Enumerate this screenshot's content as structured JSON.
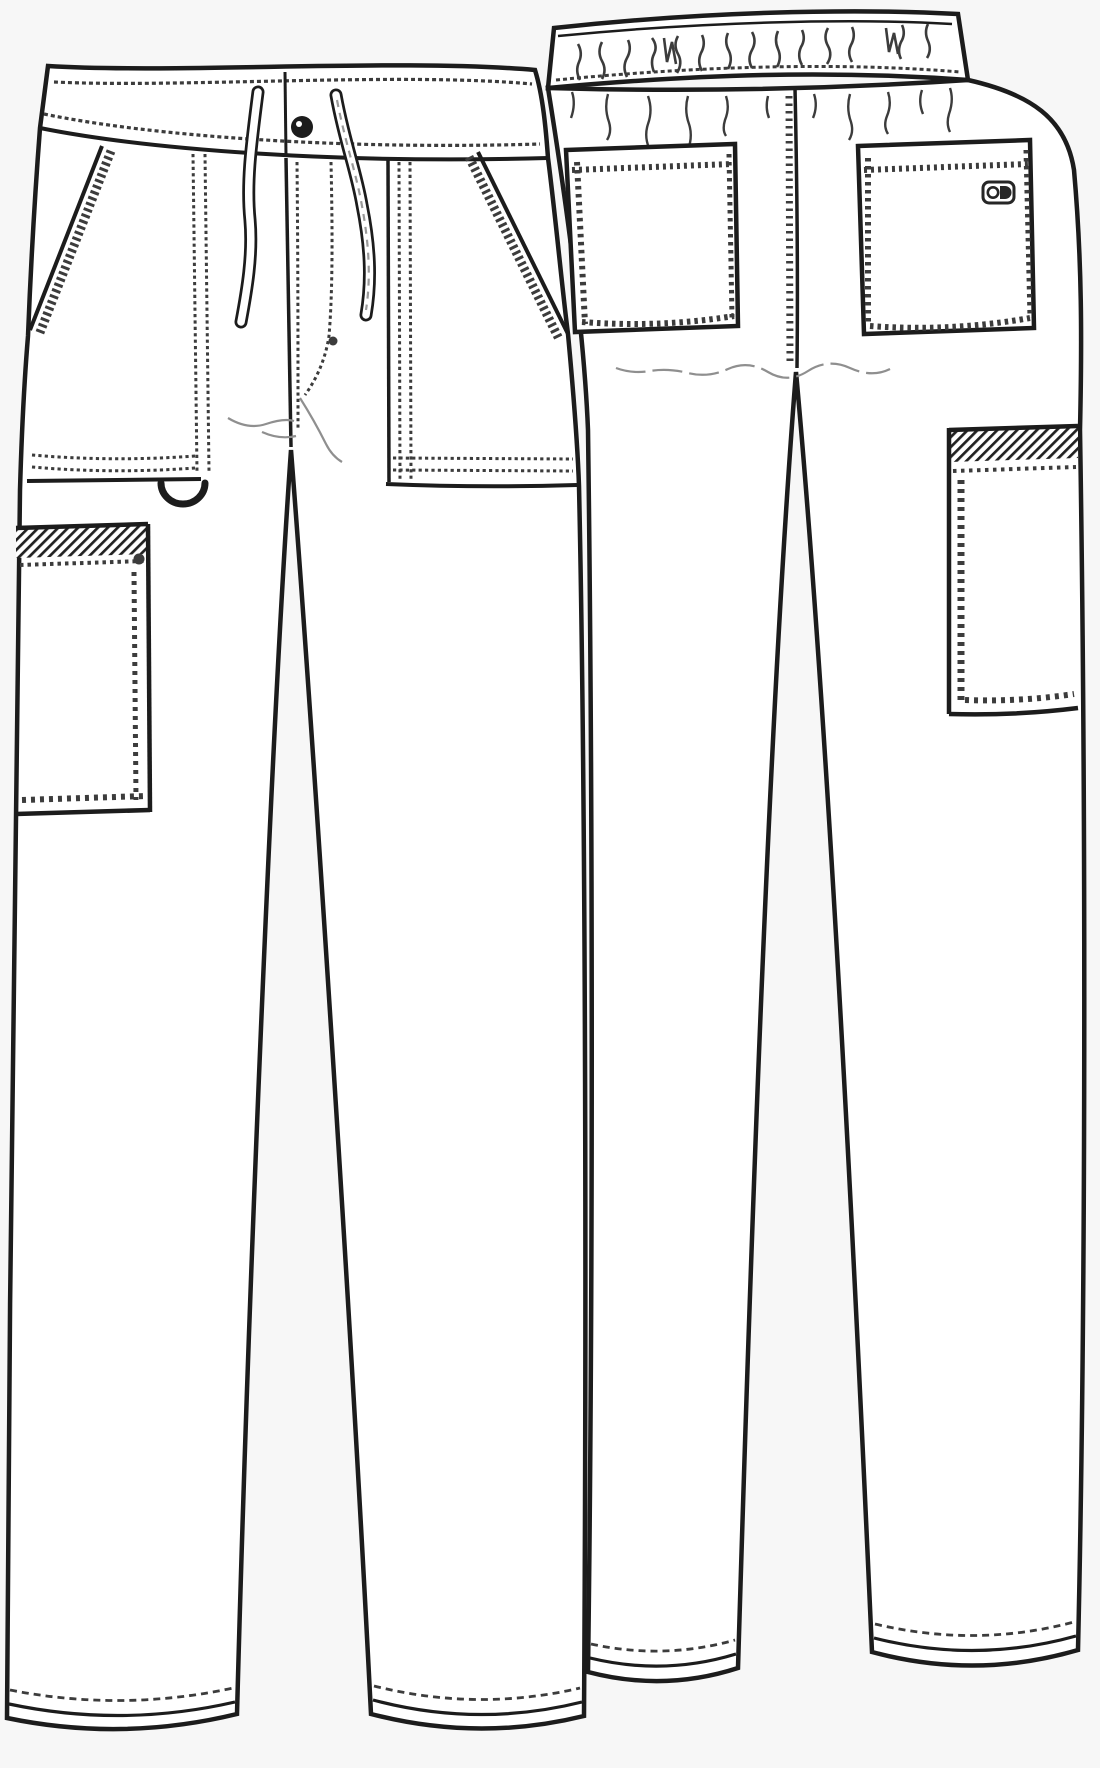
{
  "document": {
    "title": "Garment technical flat sketch - unisex drawstring cargo scrub pants",
    "views": {
      "front": {
        "label": "front view"
      },
      "back": {
        "label": "back view"
      }
    }
  },
  "drawing": {
    "colors": {
      "line": "#1c1c1c",
      "stitch": "#3c3c3c",
      "drape": "#8f8f8f",
      "fill": "#ffffff",
      "logo": "#262626",
      "background": "#f7f7f7"
    },
    "front_features": [
      "straight waistband with edge topstitching",
      "drawstring with two hanging ties",
      "center front button",
      "fly with J-topstitch and bartack dot",
      "slanted hand pockets with contrast woven trim",
      "dotted pocket-bag stitching",
      "D-ring instrument loop under right pocket bag",
      "side cargo pocket with hatched trim band",
      "topstitched leg hems"
    ],
    "back_features": [
      "elastic waistband with shirring marks",
      "gathering wrinkles below waistband",
      "center back seam with ladder stitching",
      "two patch pockets with overlock stitching",
      "brand tab on right patch pocket",
      "side cargo pocket with hatched trim band",
      "topstitched leg hems"
    ]
  }
}
